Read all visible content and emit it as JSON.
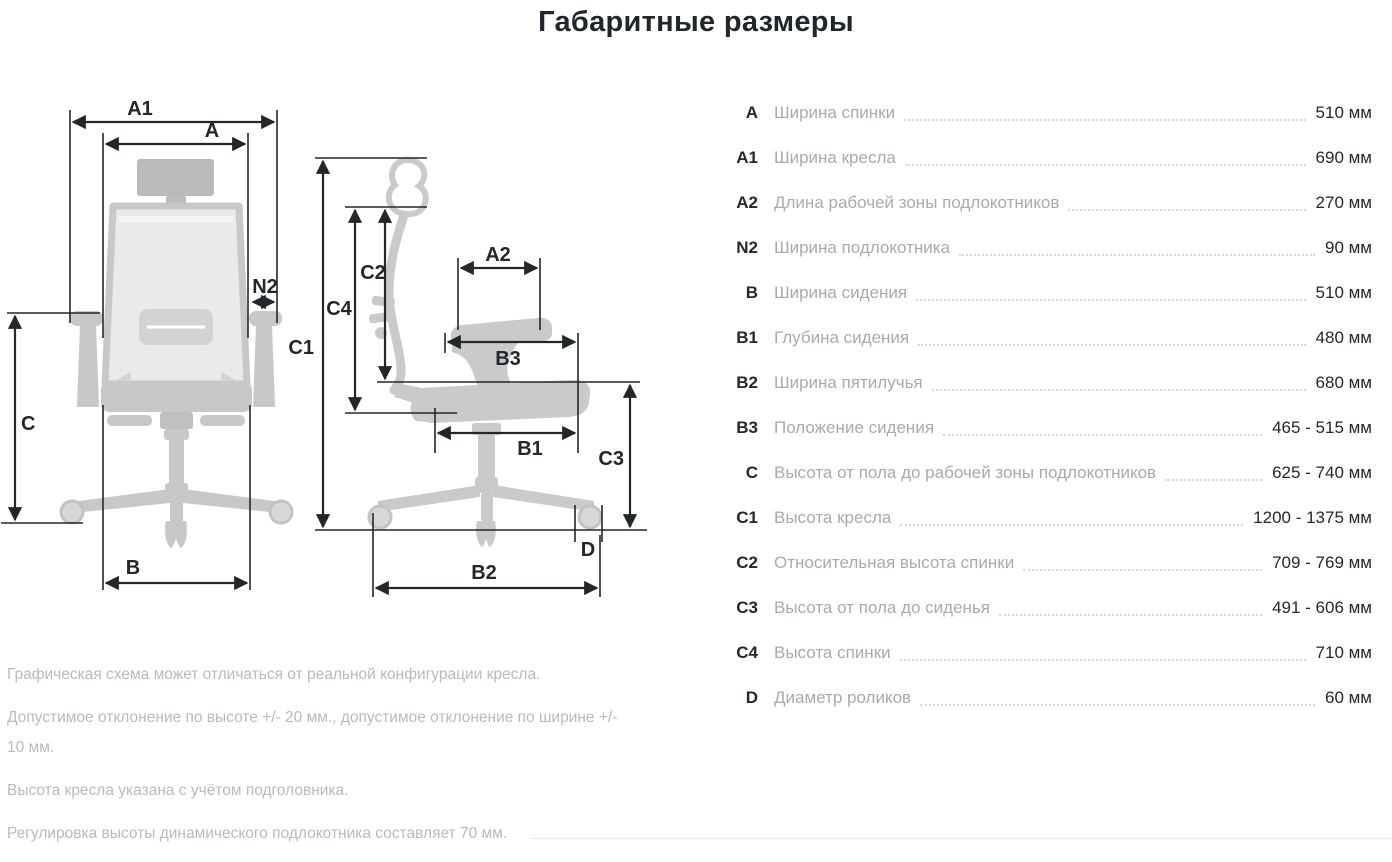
{
  "title": "Габаритные размеры",
  "dimensions": [
    {
      "code": "A",
      "name": "Ширина спинки",
      "value": "510 мм"
    },
    {
      "code": "A1",
      "name": "Ширина кресла",
      "value": "690 мм"
    },
    {
      "code": "A2",
      "name": "Длина рабочей зоны подлокотников",
      "value": "270 мм"
    },
    {
      "code": "N2",
      "name": "Ширина подлокотника",
      "value": "90 мм"
    },
    {
      "code": "B",
      "name": "Ширина сидения",
      "value": "510 мм"
    },
    {
      "code": "B1",
      "name": "Глубина сидения",
      "value": "480 мм"
    },
    {
      "code": "B2",
      "name": "Ширина пятилучья",
      "value": "680 мм"
    },
    {
      "code": "B3",
      "name": "Положение сидения",
      "value": "465 - 515 мм"
    },
    {
      "code": "C",
      "name": "Высота от пола до рабочей зоны подлокотников",
      "value": "625 - 740 мм"
    },
    {
      "code": "C1",
      "name": "Высота кресла",
      "value": "1200 - 1375 мм"
    },
    {
      "code": "C2",
      "name": "Относительная высота спинки",
      "value": "709 - 769 мм"
    },
    {
      "code": "C3",
      "name": "Высота от пола до сиденья",
      "value": "491 - 606 мм"
    },
    {
      "code": "C4",
      "name": "Высота спинки",
      "value": "710 мм"
    },
    {
      "code": "D",
      "name": "Диаметр роликов",
      "value": "60 мм"
    }
  ],
  "notes": [
    "Графическая схема может отличаться от реальной конфигурации кресла.",
    "Допустимое отклонение по высоте +/- 20 мм., допустимое отклонение по ширине +/- 10 мм.",
    "Высота кресла указана с учётом подголовника.",
    "Регулировка высоты динамического подлокотника составляет 70 мм."
  ],
  "diagram": {
    "front": {
      "a1": "A1",
      "a": "A",
      "n2": "N2",
      "c": "C",
      "b": "B"
    },
    "side": {
      "c1": "C1",
      "c2": "C2",
      "c4": "C4",
      "a2": "A2",
      "b3": "B3",
      "b1": "B1",
      "c3": "C3",
      "d": "D",
      "b2": "B2"
    }
  },
  "colors": {
    "ink": "#22272b",
    "silhouette": "#c7c9c8",
    "mesh_light": "#e9eae9",
    "spec_name_gray": "#a6abae",
    "notes_gray": "#b6bbbe",
    "leader_dots": "#d6d9db"
  }
}
